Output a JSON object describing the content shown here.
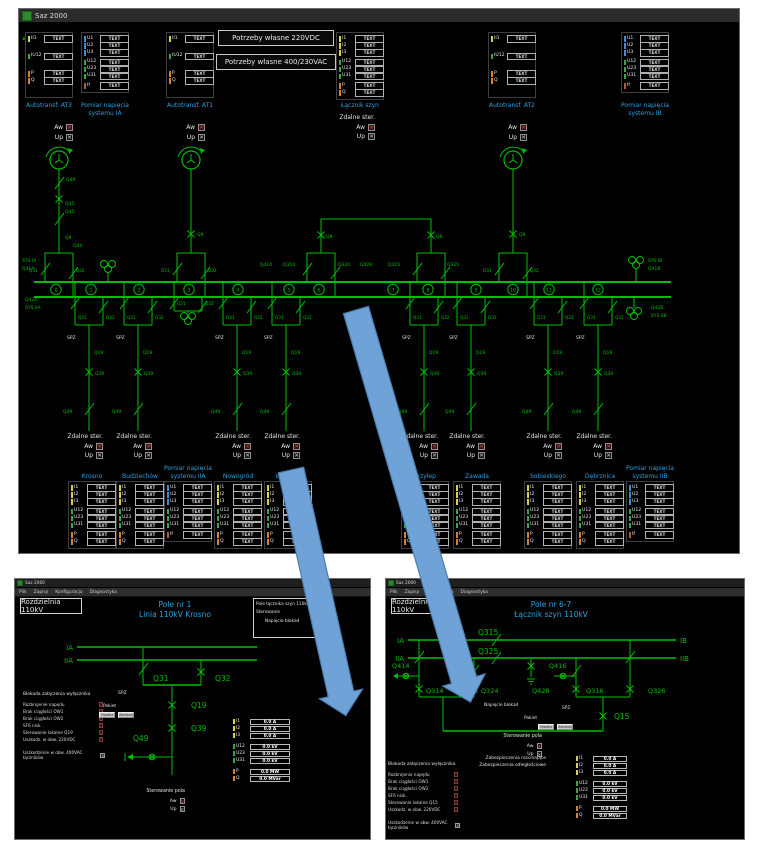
{
  "app": {
    "title": "Saz 2000"
  },
  "menu": [
    "Plik",
    "Zapisy",
    "Konfiguracja",
    "Diagnostyka"
  ],
  "placeholder": "TEXT",
  "colors": {
    "diagram_green": "#00bf00",
    "caption_blue": "#2da0dd",
    "bar_current": "#d8d24a",
    "bar_voltage_phase": "#3a8fd9",
    "bar_voltage": "#3aa64a",
    "bar_power": "#d9822b",
    "bar_freq": "#b05a2a",
    "arrow_blue": "#6fa3d8"
  },
  "main": {
    "self_use": [
      "Potrzeby własne 220VDC",
      "Potrzeby własne 400/230VAC"
    ],
    "check": {
      "remote": "Zdalne ster.",
      "aw": "Aw",
      "up": "Up"
    },
    "panels_top": [
      {
        "caption": "Autotransf. AT3",
        "type": "at"
      },
      {
        "caption": "Pomiar napięcia\nsystemu IA",
        "type": "pom"
      },
      {
        "caption": "Autotransf. AT1",
        "type": "at"
      },
      {
        "caption": "Łącznik szyn",
        "type": "coupler"
      },
      {
        "caption": "Autotransf. AT2",
        "type": "at"
      },
      {
        "caption": "Pomiar napięcia\nsystemu IB",
        "type": "pom"
      }
    ],
    "panels_bottom": [
      {
        "caption": "Krosno",
        "type": "feeder"
      },
      {
        "caption": "Budziechów",
        "type": "feeder"
      },
      {
        "caption": "Pomiar napięcia\nsystemu IIA",
        "type": "pom"
      },
      {
        "caption": "Nowogród",
        "type": "feeder"
      },
      {
        "caption": "Łużycka",
        "type": "feeder"
      },
      {
        "caption": "Przylep",
        "type": "feeder"
      },
      {
        "caption": "Zawada",
        "type": "feeder"
      },
      {
        "caption": "Sobieskiego",
        "type": "feeder"
      },
      {
        "caption": "Dębrznica",
        "type": "feeder"
      },
      {
        "caption": "Pomiar napięcia\nsystemu IIB",
        "type": "pom"
      }
    ],
    "row_sets": {
      "at": [
        [
          [
            "II1",
            "i"
          ]
        ],
        [
          [
            "IU12",
            "u"
          ]
        ],
        [
          [
            "P",
            "pq"
          ],
          [
            "Q",
            "pq"
          ]
        ]
      ],
      "pom": [
        [
          [
            "U1",
            "uph"
          ],
          [
            "U2",
            "uph"
          ],
          [
            "U3",
            "uph"
          ]
        ],
        [
          [
            "U12",
            "u"
          ],
          [
            "U23",
            "u"
          ],
          [
            "U31",
            "u"
          ]
        ],
        [
          [
            "If",
            "if"
          ]
        ]
      ],
      "coupler": [
        [
          [
            "I1",
            "i"
          ],
          [
            "I2",
            "i"
          ],
          [
            "I3",
            "i"
          ]
        ],
        [
          [
            "U12",
            "u"
          ],
          [
            "U23",
            "u"
          ],
          [
            "U31",
            "u"
          ]
        ],
        [
          [
            "P",
            "pq"
          ],
          [
            "Q",
            "pq"
          ]
        ]
      ],
      "feeder": [
        [
          [
            "I1",
            "i"
          ],
          [
            "I2",
            "i"
          ],
          [
            "I3",
            "i"
          ]
        ],
        [
          [
            "U12",
            "u"
          ],
          [
            "U23",
            "u"
          ],
          [
            "U31",
            "u"
          ]
        ],
        [
          [
            "P",
            "pq"
          ],
          [
            "Q",
            "pq"
          ]
        ]
      ]
    },
    "bay_labels": {
      "q31": "Q31",
      "q32": "Q32",
      "spz": "SPZ",
      "q19": "Q19",
      "q39": "Q39",
      "q49": "Q49"
    },
    "field_numbers": [
      "0",
      "1",
      "2",
      "3",
      "4",
      "5",
      "6",
      "7",
      "8",
      "9",
      "10",
      "11",
      "12"
    ],
    "device_labels": [
      "Q49",
      "Q35",
      "Q45",
      "Q9",
      "Q44",
      "Q9",
      "Q9",
      "Q8",
      "Q9",
      "Q414",
      "Q314",
      "Q324",
      "Q428",
      "Q315",
      "Q325",
      "SYS IA",
      "Q41A",
      "Q42A",
      "SYS IIA",
      "SYS IB",
      "Q41B",
      "Q42B",
      "SYS IIB"
    ]
  },
  "sub_left": {
    "station": "Rozdzielnia 110kV",
    "field_title": [
      "Pole nr 1",
      "Linia 110kV Krosno"
    ],
    "infobox": [
      "Pole łącznika szyn 110kV",
      "Sterowanie",
      "Napięcie blokad"
    ],
    "bus_labels": [
      "IA",
      "IIA"
    ],
    "device_labels": [
      "Q31",
      "Q32",
      "Q19",
      "Q39",
      "Q49"
    ],
    "spz": "SPZ",
    "blockade_header": "Blokada załączenia wyłącznika",
    "blockade_items": [
      "Rozbrojenie napędu",
      "Brak ciągłości OW1",
      "Brak ciągłości OW2",
      "SF6 nisk.",
      "Sterowanie lokalne Q19",
      "Uszkodz. w obw. 220VDC"
    ],
    "damage_note": "Uszkodzenie w obw. 400VAC łączników",
    "pakiet": "Pakiet",
    "pakiet_buttons": [
      "Otwórz",
      "Zamknij"
    ],
    "control_header": "Sterowanie pola",
    "meas": [
      [
        "I1",
        "0.0 A",
        "i"
      ],
      [
        "I2",
        "0.0 A",
        "i"
      ],
      [
        "I3",
        "0.0 A",
        "i"
      ],
      [
        "U12",
        "0.0 kV",
        "u"
      ],
      [
        "U23",
        "0.0 kV",
        "u"
      ],
      [
        "U31",
        "0.0 kV",
        "u"
      ],
      [
        "P",
        "0.0 MW",
        "pq"
      ],
      [
        "Q",
        "0.0 MVar",
        "pq"
      ]
    ]
  },
  "sub_right": {
    "station": "Rozdzielnia 110kV",
    "field_title": [
      "Pole nr 6-7",
      "Łącznik szyn 110kV"
    ],
    "bus_labels": [
      "IA",
      "IIA",
      "IB",
      "IIB"
    ],
    "device_labels": [
      "Q315",
      "Q325",
      "Q414",
      "Q416",
      "Q314",
      "Q324",
      "Q428",
      "Q316",
      "Q326",
      "Q15"
    ],
    "spz": "SPZ",
    "napiecie_blokad": "Napięcie blokad",
    "protections": [
      "Zabezpieczenia rozcinające",
      "Zabezpieczenia odległościowe"
    ],
    "blockade_header": "Blokada załączenia wyłącznika",
    "blockade_items": [
      "Rozbrojenie napędu",
      "Brak ciągłości OW1",
      "Brak ciągłości OW2",
      "SF6 nisk.",
      "Sterowanie lokalne Q15",
      "Uszkodz. w obw. 220VDC"
    ],
    "damage_note": "Uszkodzenie w obw. 400VAC łączników",
    "pakiet": "Pakiet",
    "pakiet_buttons": [
      "Otwórz",
      "Zamknij"
    ],
    "control_header": "Sterowanie pola",
    "meas": [
      [
        "I1",
        "0.0 A",
        "i"
      ],
      [
        "I2",
        "0.0 A",
        "i"
      ],
      [
        "I3",
        "0.0 A",
        "i"
      ],
      [
        "U12",
        "0.0 kV",
        "u"
      ],
      [
        "U23",
        "0.0 kV",
        "u"
      ],
      [
        "U31",
        "0.0 kV",
        "u"
      ],
      [
        "P",
        "0.0 MW",
        "pq"
      ],
      [
        "Q",
        "0.0 MVar",
        "pq"
      ]
    ]
  }
}
